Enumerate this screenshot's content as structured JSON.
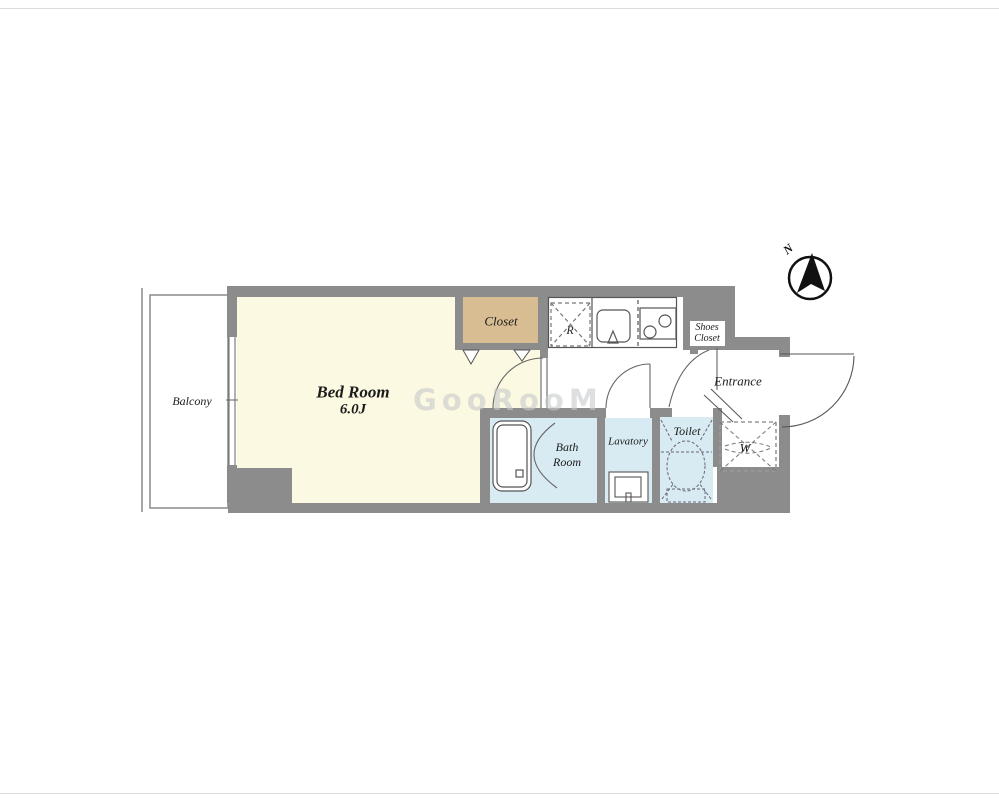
{
  "plan": {
    "title_note": "apartment floor plan",
    "rooms": {
      "balcony": "Balcony",
      "bedroom_name": "Bed Room",
      "bedroom_size": "6.0J",
      "closet": "Closet",
      "shoes_closet_line1": "Shoes",
      "shoes_closet_line2": "Closet",
      "entrance": "Entrance",
      "bath_line1": "Bath",
      "bath_line2": "Room",
      "lavatory": "Lavatory",
      "toilet": "Toilet"
    },
    "fixtures": {
      "refrigerator_mark": "R",
      "washer_mark": "W"
    },
    "compass": {
      "north": "N"
    },
    "watermark": "GooRooM",
    "colors": {
      "wall": "#8c8c8c",
      "bedroom_floor": "#fcf9e2",
      "closet_floor": "#d8bd92",
      "wet_area_floor": "#d8eaf2",
      "line": "#555555"
    }
  }
}
